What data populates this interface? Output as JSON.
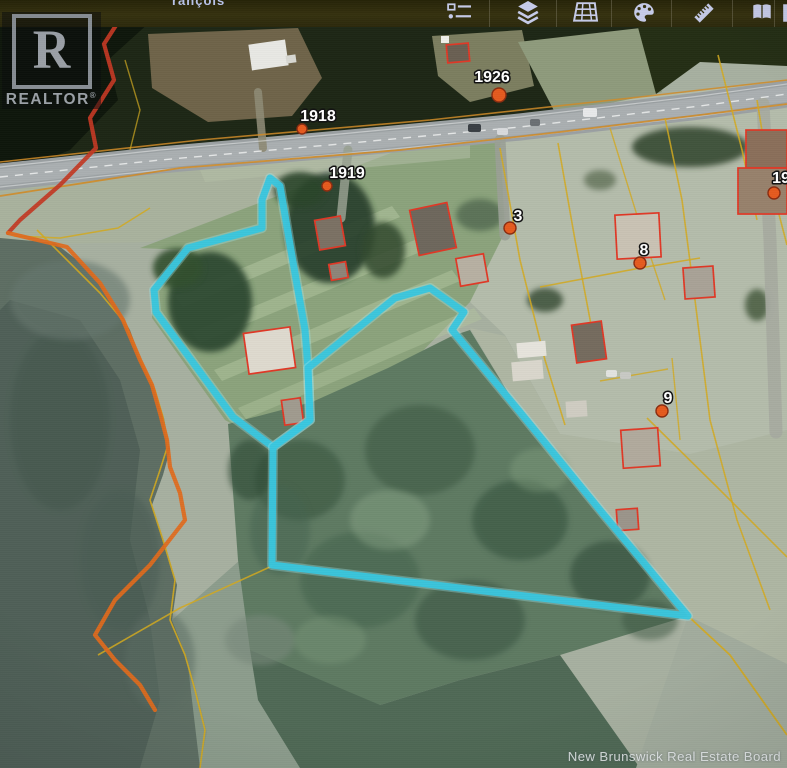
{
  "app": {
    "top_partial_text": "rançois",
    "toolbar": {
      "icons": [
        {
          "name": "legend-icon",
          "x": 442
        },
        {
          "name": "layers-icon",
          "x": 511
        },
        {
          "name": "map-grid-icon",
          "x": 568
        },
        {
          "name": "palette-icon",
          "x": 627
        },
        {
          "name": "ruler-icon",
          "x": 687
        },
        {
          "name": "book-icon",
          "x": 745
        },
        {
          "name": "partial-icon",
          "x": 776
        }
      ],
      "separators_x": [
        489,
        556,
        611,
        671,
        732,
        774
      ],
      "icon_color": "#c6cbe9"
    }
  },
  "branding": {
    "realtor_letter": "R",
    "realtor_text": "REALTOR",
    "realtor_reg": "®",
    "board_watermark": "New Brunswick Real Estate Board"
  },
  "map": {
    "colors": {
      "boundary": "#38c6de",
      "cadastral_yellow": "#d2a91f",
      "shore_orange": "#e06a1c",
      "shore_red": "#c23824",
      "house_outline": "#e03826",
      "road_fill": "#9ba1a3",
      "marker_fill": "#e55a1e",
      "marker_rim": "#8a2c10",
      "label_fill": "#ffffff",
      "label_stroke": "#101010"
    },
    "terrain": [
      {
        "type": "rect",
        "x": 0,
        "y": 0,
        "w": 787,
        "h": 768,
        "fill": "#a7b0a0"
      },
      {
        "type": "poly",
        "pts": "0,20 787,20 787,62 700,60 640,96 560,122 430,140 200,162 0,182",
        "fill": "#1d2715"
      },
      {
        "type": "poly",
        "pts": "0,22 150,22 108,60 118,100 70,150 0,178",
        "fill": "#0e160b"
      },
      {
        "type": "poly",
        "pts": "148,34 298,28 322,78 292,116 208,122 152,88",
        "fill": "#6f6449"
      },
      {
        "type": "poly",
        "pts": "432,36 522,30 534,86 470,102 438,76",
        "fill": "#7c7e60"
      },
      {
        "type": "poly",
        "pts": "518,42 640,28 662,92 560,122",
        "fill": "#8e9a7c"
      },
      {
        "type": "poly",
        "pts": "636,20 787,20 787,66 700,62 656,94",
        "fill": "#242e14"
      },
      {
        "type": "poly",
        "pts": "430,140 640,97 787,80 787,432 690,454 560,434 505,335 470,302 500,232 498,150",
        "fill": "#b4bcab"
      },
      {
        "type": "poly",
        "pts": "0,182 200,162 340,150 310,190 150,242 0,245",
        "fill": "#a9b29d"
      },
      {
        "type": "poly",
        "pts": "140,248 420,142 500,138 505,232 470,302 310,468 225,420 152,318 152,290 186,250",
        "fill": "#8ba37c"
      },
      {
        "type": "poly",
        "pts": "175,296 392,206 400,217 183,307",
        "fill": "#b2c59e",
        "op": 0.55
      },
      {
        "type": "poly",
        "pts": "192,332 422,237 430,248 200,343",
        "fill": "#b2c59e",
        "op": 0.5
      },
      {
        "type": "poly",
        "pts": "214,370 452,270 460,281 222,381",
        "fill": "#b2c59e",
        "op": 0.5
      },
      {
        "type": "poly",
        "pts": "238,408 474,308 482,319 246,419",
        "fill": "#b2c59e",
        "op": 0.42
      },
      {
        "type": "poly",
        "pts": "200,170 470,145 470,158 205,182",
        "fill": "#b6bfa8",
        "op": 0.5
      },
      {
        "type": "poly",
        "pts": "0,238 55,243 90,270 112,300 130,330 143,366 155,390 164,418 170,450 163,475 152,505 165,545 177,585 172,620 187,658 197,692 207,732 200,768 0,768",
        "fill": "#5d6e63"
      },
      {
        "type": "poly",
        "pts": "10,300 80,320 120,380 140,450 130,540 150,620 160,700 140,768 0,768 0,310",
        "fill": "#4c5d54",
        "op": 0.8
      },
      {
        "type": "poly",
        "pts": "172,620 240,560 258,680 380,705 360,768 200,768 187,658",
        "fill": "#8a9a8a",
        "op": 0.9
      },
      {
        "type": "poly",
        "pts": "228,424 312,402 388,368 452,336 470,330 520,412 600,508 688,616 560,655 460,680 380,705 300,690 250,650 238,560",
        "fill": "#5e7a62"
      },
      {
        "type": "poly",
        "pts": "250,650 380,705 460,680 560,655 640,768 300,768 258,700",
        "fill": "#4f6955"
      },
      {
        "type": "poly",
        "pts": "470,328 520,412 600,508 688,616 770,656 787,664 787,430 690,454 560,434 505,336",
        "fill": "#aeb6a3"
      },
      {
        "type": "poly",
        "pts": "688,616 787,664 787,768 636,768",
        "fill": "#a2ac9d"
      },
      {
        "type": "ellipse",
        "cx": 60,
        "cy": 420,
        "rx": 50,
        "ry": 90,
        "fill": "#42544c",
        "op": 0.5,
        "blur": 1
      },
      {
        "type": "ellipse",
        "cx": 120,
        "cy": 560,
        "rx": 40,
        "ry": 70,
        "fill": "#4a5c52",
        "op": 0.5,
        "blur": 1
      },
      {
        "type": "ellipse",
        "cx": 70,
        "cy": 300,
        "rx": 60,
        "ry": 40,
        "fill": "#66776e",
        "op": 0.6,
        "blur": 1
      },
      {
        "type": "ellipse",
        "cx": 160,
        "cy": 660,
        "rx": 35,
        "ry": 50,
        "fill": "#5a6c62",
        "op": 0.5,
        "blur": 1
      },
      {
        "type": "ellipse",
        "cx": 260,
        "cy": 640,
        "rx": 35,
        "ry": 25,
        "fill": "#78887a",
        "op": 0.6,
        "blur": 1
      },
      {
        "type": "ellipse",
        "cx": 210,
        "cy": 302,
        "rx": 42,
        "ry": 50,
        "fill": "#2e4a32",
        "op": 0.95,
        "blur": 1
      },
      {
        "type": "ellipse",
        "cx": 178,
        "cy": 268,
        "rx": 25,
        "ry": 20,
        "fill": "#33502f",
        "op": 0.9,
        "blur": 1
      },
      {
        "type": "ellipse",
        "cx": 330,
        "cy": 228,
        "rx": 45,
        "ry": 55,
        "fill": "#263d2a",
        "op": 0.9,
        "blur": 1
      },
      {
        "type": "ellipse",
        "cx": 300,
        "cy": 190,
        "rx": 26,
        "ry": 18,
        "fill": "#2c452c",
        "op": 0.9,
        "blur": 1
      },
      {
        "type": "ellipse",
        "cx": 383,
        "cy": 250,
        "rx": 22,
        "ry": 28,
        "fill": "#31492f",
        "op": 0.85,
        "blur": 1
      },
      {
        "type": "ellipse",
        "cx": 545,
        "cy": 300,
        "rx": 18,
        "ry": 12,
        "fill": "#3a5038",
        "op": 0.85,
        "blur": 1
      },
      {
        "type": "ellipse",
        "cx": 480,
        "cy": 215,
        "rx": 24,
        "ry": 16,
        "fill": "#49604a",
        "op": 0.7,
        "blur": 1
      },
      {
        "type": "ellipse",
        "cx": 690,
        "cy": 147,
        "rx": 58,
        "ry": 20,
        "fill": "#2e4229",
        "op": 0.85,
        "blur": 1
      },
      {
        "type": "ellipse",
        "cx": 757,
        "cy": 305,
        "rx": 12,
        "ry": 16,
        "fill": "#3f5538",
        "op": 0.8,
        "blur": 1
      },
      {
        "type": "ellipse",
        "cx": 600,
        "cy": 180,
        "rx": 16,
        "ry": 10,
        "fill": "#56684e",
        "op": 0.7,
        "blur": 1
      },
      {
        "type": "ellipse",
        "cx": 300,
        "cy": 480,
        "rx": 45,
        "ry": 40,
        "fill": "#38543e",
        "op": 0.6,
        "blur": 1
      },
      {
        "type": "ellipse",
        "cx": 420,
        "cy": 450,
        "rx": 55,
        "ry": 45,
        "fill": "#3a5740",
        "op": 0.55,
        "blur": 1
      },
      {
        "type": "ellipse",
        "cx": 520,
        "cy": 520,
        "rx": 48,
        "ry": 40,
        "fill": "#36523c",
        "op": 0.6,
        "blur": 1
      },
      {
        "type": "ellipse",
        "cx": 610,
        "cy": 575,
        "rx": 40,
        "ry": 34,
        "fill": "#324e3a",
        "op": 0.6,
        "blur": 1
      },
      {
        "type": "ellipse",
        "cx": 360,
        "cy": 580,
        "rx": 60,
        "ry": 48,
        "fill": "#40604a",
        "op": 0.5,
        "blur": 1
      },
      {
        "type": "ellipse",
        "cx": 470,
        "cy": 620,
        "rx": 55,
        "ry": 40,
        "fill": "#375340",
        "op": 0.55,
        "blur": 1
      },
      {
        "type": "ellipse",
        "cx": 280,
        "cy": 530,
        "rx": 30,
        "ry": 45,
        "fill": "#456350",
        "op": 0.5,
        "blur": 1
      },
      {
        "type": "ellipse",
        "cx": 390,
        "cy": 520,
        "rx": 40,
        "ry": 30,
        "fill": "#8aa487",
        "op": 0.45,
        "blur": 1
      },
      {
        "type": "ellipse",
        "cx": 540,
        "cy": 470,
        "rx": 30,
        "ry": 22,
        "fill": "#84a080",
        "op": 0.4,
        "blur": 1
      },
      {
        "type": "ellipse",
        "cx": 330,
        "cy": 640,
        "rx": 36,
        "ry": 24,
        "fill": "#7e9a7c",
        "op": 0.4,
        "blur": 1
      },
      {
        "type": "ellipse",
        "cx": 250,
        "cy": 470,
        "rx": 22,
        "ry": 30,
        "fill": "#2f4a36",
        "op": 0.6,
        "blur": 1
      },
      {
        "type": "ellipse",
        "cx": 650,
        "cy": 620,
        "rx": 28,
        "ry": 20,
        "fill": "#3a5540",
        "op": 0.5,
        "blur": 1
      }
    ],
    "roads": [
      {
        "name": "highway",
        "pts": "0,177 160,160 340,144 520,127 700,106 787,94",
        "w": 27,
        "color": "#9ba1a3"
      },
      {
        "name": "highway-worn",
        "pts": "0,177 160,160 340,144 520,127 700,106 787,94",
        "w": 16,
        "color": "#b0b5b6",
        "op": 0.7
      },
      {
        "name": "side-road-east",
        "pts": "763,104 770,240 776,432",
        "w": 13,
        "color": "#a6aaa0",
        "op": 0.9
      },
      {
        "name": "driveway-cluster",
        "pts": "500,140 505,235",
        "w": 11,
        "color": "#9aa096",
        "op": 0.9
      },
      {
        "name": "driveway-barn",
        "pts": "348,150 341,218",
        "w": 9,
        "color": "#98a090",
        "op": 0.85
      },
      {
        "name": "driveway-trailer",
        "pts": "258,92 263,148",
        "w": 8,
        "color": "#8d8a74",
        "op": 0.9
      }
    ],
    "road_lines": [
      {
        "pts": "0,167 160,150 340,134 520,117 700,96 787,84",
        "w": 1.2,
        "color": "#e8eaea",
        "op": 0.55,
        "dash": ""
      },
      {
        "pts": "0,187 160,170 340,154 520,137 700,116 787,104",
        "w": 1.2,
        "color": "#e8eaea",
        "op": 0.5,
        "dash": ""
      },
      {
        "pts": "0,177 160,160 340,144 520,127 700,106 787,94",
        "w": 1.4,
        "color": "#f2f4f4",
        "op": 0.8,
        "dash": "8 7"
      }
    ],
    "cadastral": [
      {
        "pts": "0,196 180,168 400,150 560,132 700,115 787,104",
        "color": "#cf8b28",
        "w": 1.8,
        "op": 0.9
      },
      {
        "pts": "0,162 200,140 430,120 640,97 787,80",
        "color": "#cf8b28",
        "w": 1.6,
        "op": 0.85
      },
      {
        "pts": "500,148 520,260 545,360 565,425",
        "color": "#d2a91f",
        "w": 1.6,
        "op": 0.85
      },
      {
        "pts": "558,143 575,240 592,330",
        "color": "#d2a91f",
        "w": 1.6,
        "op": 0.85
      },
      {
        "pts": "540,287 640,268 700,258",
        "color": "#d2a91f",
        "w": 1.6,
        "op": 0.85
      },
      {
        "pts": "610,128 640,225 665,300",
        "color": "#d2a91f",
        "w": 1.4,
        "op": 0.8
      },
      {
        "pts": "665,118 682,200 695,300 710,420 737,520 770,610",
        "color": "#d2a91f",
        "w": 1.6,
        "op": 0.85
      },
      {
        "pts": "718,55 742,150 757,220",
        "color": "#d2a91f",
        "w": 1.6,
        "op": 0.85
      },
      {
        "pts": "757,100 770,180 787,245",
        "color": "#d2a91f",
        "w": 1.6,
        "op": 0.85
      },
      {
        "pts": "647,418 720,490 787,557",
        "color": "#d2a91f",
        "w": 1.6,
        "op": 0.85
      },
      {
        "pts": "600,381 668,369",
        "color": "#d2a91f",
        "w": 1.4,
        "op": 0.8
      },
      {
        "pts": "672,358 680,440",
        "color": "#d2a91f",
        "w": 1.4,
        "op": 0.8
      },
      {
        "pts": "688,616 730,655 787,735",
        "color": "#d2a91f",
        "w": 1.8,
        "op": 0.9
      },
      {
        "pts": "98,655 180,608 272,566",
        "color": "#d2a91f",
        "w": 1.6,
        "op": 0.85
      },
      {
        "pts": "150,208 118,228 60,238 14,236",
        "color": "#d2a91f",
        "w": 1.5,
        "op": 0.85
      },
      {
        "pts": "37,230 100,293 125,323 143,365 155,390 163,417 168,445 160,470 150,500 163,540 175,580 170,620 185,655 195,690 205,730 200,768",
        "color": "#d2a91f",
        "w": 1.6,
        "op": 0.9
      },
      {
        "pts": "125,60 140,110 130,150",
        "color": "#d2a91f",
        "w": 1.4,
        "op": 0.7
      }
    ],
    "shore_lines": [
      {
        "pts": "122,16 104,44 114,80 90,118 96,148 60,185 20,220 8,233",
        "color": "#c23824",
        "w": 4.2,
        "op": 0.92
      },
      {
        "pts": "8,233 67,247 100,283 123,320 140,360 152,385 160,413 167,440 170,467 180,493 185,520 150,565 115,600 95,635 115,660 140,685 155,710",
        "color": "#e06a1c",
        "w": 4.2,
        "op": 0.92
      }
    ],
    "boundary_parcels": [
      {
        "name": "flag-lot-boundary",
        "pts": "270,178 262,200 262,228 188,248 154,290 156,312 233,417 273,447 310,420 308,368 305,330 293,262 280,186 270,178"
      },
      {
        "name": "main-lot-boundary",
        "pts": "308,368 395,298 430,288 464,312 452,330 520,412 600,510 688,616 272,565 273,447 310,420 308,368"
      }
    ],
    "houses": [
      {
        "x": 250,
        "y": 42,
        "w": 37,
        "h": 26,
        "rot": -8,
        "fill": "#e8e8e4",
        "outline": false
      },
      {
        "x": 286,
        "y": 55,
        "w": 10,
        "h": 8,
        "rot": -8,
        "fill": "#d8d8d2",
        "outline": false
      },
      {
        "x": 447,
        "y": 44,
        "w": 22,
        "h": 18,
        "rot": -5,
        "fill": "#6a5f52",
        "outline": true
      },
      {
        "x": 441,
        "y": 36,
        "w": 8,
        "h": 7,
        "rot": 0,
        "fill": "#f0f0ea",
        "outline": false
      },
      {
        "x": 317,
        "y": 218,
        "w": 26,
        "h": 30,
        "rot": -10,
        "fill": "#7b7164",
        "outline": true
      },
      {
        "x": 330,
        "y": 263,
        "w": 17,
        "h": 16,
        "rot": -10,
        "fill": "#8d8478",
        "outline": true
      },
      {
        "x": 414,
        "y": 206,
        "w": 38,
        "h": 46,
        "rot": -12,
        "fill": "#6e675c",
        "outline": true
      },
      {
        "x": 458,
        "y": 256,
        "w": 28,
        "h": 28,
        "rot": -10,
        "fill": "#b7b0a2",
        "outline": true
      },
      {
        "x": 246,
        "y": 330,
        "w": 47,
        "h": 41,
        "rot": -8,
        "fill": "#ded9ce",
        "outline": true
      },
      {
        "x": 283,
        "y": 399,
        "w": 19,
        "h": 25,
        "rot": -8,
        "fill": "#a09a8e",
        "outline": true
      },
      {
        "x": 616,
        "y": 214,
        "w": 44,
        "h": 44,
        "rot": -3,
        "fill": "#c9c2b4",
        "outline": true
      },
      {
        "x": 684,
        "y": 267,
        "w": 30,
        "h": 31,
        "rot": -4,
        "fill": "#a9a296",
        "outline": true
      },
      {
        "x": 746,
        "y": 130,
        "w": 41,
        "h": 38,
        "rot": 0,
        "fill": "#8a6f5a",
        "outline": true
      },
      {
        "x": 738,
        "y": 168,
        "w": 49,
        "h": 46,
        "rot": 0,
        "fill": "#97816c",
        "outline": true
      },
      {
        "x": 574,
        "y": 323,
        "w": 30,
        "h": 38,
        "rot": -8,
        "fill": "#756b5e",
        "outline": true
      },
      {
        "x": 517,
        "y": 342,
        "w": 29,
        "h": 15,
        "rot": -5,
        "fill": "#e6e4dc",
        "outline": false
      },
      {
        "x": 512,
        "y": 361,
        "w": 31,
        "h": 19,
        "rot": -5,
        "fill": "#d9d6cc",
        "outline": false
      },
      {
        "x": 622,
        "y": 429,
        "w": 37,
        "h": 38,
        "rot": -4,
        "fill": "#b1aa9c",
        "outline": true
      },
      {
        "x": 566,
        "y": 401,
        "w": 21,
        "h": 16,
        "rot": -4,
        "fill": "#cfccc2",
        "outline": false
      },
      {
        "x": 617,
        "y": 509,
        "w": 21,
        "h": 21,
        "rot": -4,
        "fill": "#9b948a",
        "outline": true
      }
    ],
    "cars": [
      {
        "x": 468,
        "y": 124,
        "w": 13,
        "h": 8,
        "fill": "#3a3f44"
      },
      {
        "x": 497,
        "y": 128,
        "w": 11,
        "h": 7,
        "fill": "#d8dadc"
      },
      {
        "x": 530,
        "y": 119,
        "w": 10,
        "h": 7,
        "fill": "#6b7074"
      },
      {
        "x": 583,
        "y": 108,
        "w": 14,
        "h": 9,
        "fill": "#e8e9ea"
      },
      {
        "x": 606,
        "y": 370,
        "w": 11,
        "h": 7,
        "fill": "#e2e3e0"
      },
      {
        "x": 620,
        "y": 372,
        "w": 11,
        "h": 7,
        "fill": "#c8c9c4"
      }
    ],
    "labels": [
      {
        "text": "1918",
        "x": 318,
        "y": 121,
        "mx": 302,
        "my": 129,
        "r": 5
      },
      {
        "text": "1926",
        "x": 492,
        "y": 82,
        "mx": 499,
        "my": 95,
        "r": 7
      },
      {
        "text": "1919",
        "x": 347,
        "y": 178,
        "mx": 327,
        "my": 186,
        "r": 5
      },
      {
        "text": "3",
        "x": 518,
        "y": 221,
        "mx": 510,
        "my": 228,
        "r": 6
      },
      {
        "text": "8",
        "x": 644,
        "y": 255,
        "mx": 640,
        "my": 263,
        "r": 6
      },
      {
        "text": "9",
        "x": 668,
        "y": 403,
        "mx": 662,
        "my": 411,
        "r": 6
      },
      {
        "text": "19",
        "x": 781,
        "y": 183,
        "mx": 774,
        "my": 193,
        "r": 6
      }
    ]
  }
}
